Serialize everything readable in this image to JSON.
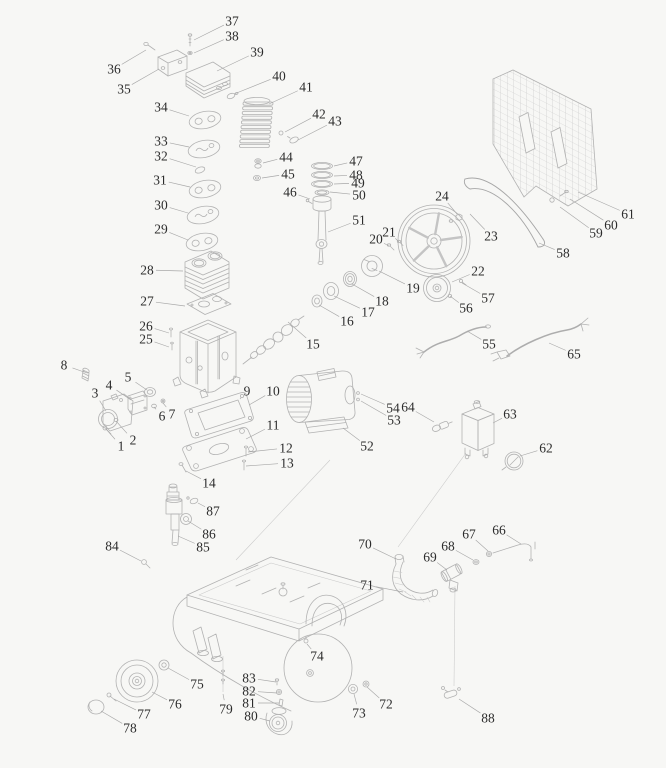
{
  "page": {
    "background_color": "#f7f7f5",
    "line_color": "#b2b2b2",
    "leader_color": "#a8a8a8",
    "label_color": "#2c2c2c"
  },
  "diagram": {
    "type": "exploded-parts-diagram",
    "subject": "belt-driven air compressor parts schematic",
    "part_count": 88,
    "callouts": [
      {
        "n": "1",
        "x": 121,
        "y": 446,
        "tx": 106,
        "ty": 429
      },
      {
        "n": "2",
        "x": 133,
        "y": 440,
        "tx": 116,
        "ty": 421
      },
      {
        "n": "3",
        "x": 95,
        "y": 393,
        "tx": 106,
        "ty": 411
      },
      {
        "n": "4",
        "x": 109,
        "y": 385,
        "tx": 131,
        "ty": 400
      },
      {
        "n": "5",
        "x": 128,
        "y": 377,
        "tx": 147,
        "ty": 390
      },
      {
        "n": "6",
        "x": 162,
        "y": 416,
        "tx": 154,
        "ty": 407
      },
      {
        "n": "7",
        "x": 172,
        "y": 414,
        "tx": 163,
        "ty": 403
      },
      {
        "n": "8",
        "x": 64,
        "y": 365,
        "tx": 84,
        "ty": 372
      },
      {
        "n": "9",
        "x": 247,
        "y": 391,
        "tx": 240,
        "ty": 399
      },
      {
        "n": "10",
        "x": 273,
        "y": 391,
        "tx": 249,
        "ty": 405
      },
      {
        "n": "11",
        "x": 273,
        "y": 425,
        "tx": 246,
        "ty": 439
      },
      {
        "n": "12",
        "x": 286,
        "y": 448,
        "tx": 248,
        "ty": 452
      },
      {
        "n": "13",
        "x": 287,
        "y": 463,
        "tx": 246,
        "ty": 466
      },
      {
        "n": "14",
        "x": 209,
        "y": 483,
        "tx": 186,
        "ty": 471
      },
      {
        "n": "15",
        "x": 313,
        "y": 344,
        "tx": 288,
        "ty": 322
      },
      {
        "n": "16",
        "x": 347,
        "y": 321,
        "tx": 319,
        "ty": 305
      },
      {
        "n": "17",
        "x": 368,
        "y": 312,
        "tx": 334,
        "ty": 296
      },
      {
        "n": "18",
        "x": 382,
        "y": 301,
        "tx": 352,
        "ty": 284
      },
      {
        "n": "19",
        "x": 413,
        "y": 288,
        "tx": 379,
        "ty": 271
      },
      {
        "n": "20",
        "x": 376,
        "y": 239,
        "tx": 389,
        "ty": 246
      },
      {
        "n": "21",
        "x": 389,
        "y": 232,
        "tx": 399,
        "ty": 242
      },
      {
        "n": "22",
        "x": 478,
        "y": 271,
        "tx": 452,
        "ty": 282
      },
      {
        "n": "23",
        "x": 491,
        "y": 236,
        "tx": 470,
        "ty": 214
      },
      {
        "n": "24",
        "x": 442,
        "y": 196,
        "tx": 457,
        "ty": 214
      },
      {
        "n": "25",
        "x": 146,
        "y": 339,
        "tx": 169,
        "ty": 347
      },
      {
        "n": "26",
        "x": 146,
        "y": 326,
        "tx": 169,
        "ty": 333
      },
      {
        "n": "27",
        "x": 147,
        "y": 301,
        "tx": 185,
        "ty": 306
      },
      {
        "n": "28",
        "x": 147,
        "y": 270,
        "tx": 183,
        "ty": 271
      },
      {
        "n": "29",
        "x": 161,
        "y": 229,
        "tx": 188,
        "ty": 240
      },
      {
        "n": "30",
        "x": 161,
        "y": 205,
        "tx": 188,
        "ty": 213
      },
      {
        "n": "31",
        "x": 160,
        "y": 180,
        "tx": 190,
        "ty": 187
      },
      {
        "n": "32",
        "x": 161,
        "y": 156,
        "tx": 196,
        "ty": 167
      },
      {
        "n": "33",
        "x": 161,
        "y": 141,
        "tx": 189,
        "ty": 147
      },
      {
        "n": "34",
        "x": 161,
        "y": 107,
        "tx": 189,
        "ty": 116
      },
      {
        "n": "35",
        "x": 124,
        "y": 89,
        "tx": 159,
        "ty": 69
      },
      {
        "n": "36",
        "x": 114,
        "y": 69,
        "tx": 146,
        "ty": 50
      },
      {
        "n": "37",
        "x": 232,
        "y": 21,
        "tx": 194,
        "ty": 40
      },
      {
        "n": "38",
        "x": 232,
        "y": 36,
        "tx": 194,
        "ty": 53
      },
      {
        "n": "39",
        "x": 257,
        "y": 52,
        "tx": 217,
        "ty": 71
      },
      {
        "n": "40",
        "x": 279,
        "y": 76,
        "tx": 234,
        "ty": 94
      },
      {
        "n": "41",
        "x": 306,
        "y": 87,
        "tx": 269,
        "ty": 104
      },
      {
        "n": "42",
        "x": 319,
        "y": 114,
        "tx": 285,
        "ty": 132
      },
      {
        "n": "43",
        "x": 335,
        "y": 121,
        "tx": 298,
        "ty": 140
      },
      {
        "n": "44",
        "x": 286,
        "y": 157,
        "tx": 263,
        "ty": 163
      },
      {
        "n": "45",
        "x": 288,
        "y": 174,
        "tx": 262,
        "ty": 178
      },
      {
        "n": "46",
        "x": 290,
        "y": 192,
        "tx": 310,
        "ty": 199
      },
      {
        "n": "47",
        "x": 356,
        "y": 161,
        "tx": 334,
        "ty": 166
      },
      {
        "n": "48",
        "x": 356,
        "y": 175,
        "tx": 334,
        "ty": 176
      },
      {
        "n": "49",
        "x": 358,
        "y": 183,
        "tx": 334,
        "ty": 184
      },
      {
        "n": "50",
        "x": 359,
        "y": 195,
        "tx": 330,
        "ty": 192
      },
      {
        "n": "51",
        "x": 359,
        "y": 220,
        "tx": 328,
        "ty": 232
      },
      {
        "n": "52",
        "x": 367,
        "y": 446,
        "tx": 343,
        "ty": 428
      },
      {
        "n": "53",
        "x": 394,
        "y": 420,
        "tx": 361,
        "ty": 401
      },
      {
        "n": "54",
        "x": 393,
        "y": 408,
        "tx": 361,
        "ty": 394
      },
      {
        "n": "55",
        "x": 489,
        "y": 344,
        "tx": 467,
        "ty": 331
      },
      {
        "n": "56",
        "x": 466,
        "y": 308,
        "tx": 450,
        "ty": 296
      },
      {
        "n": "57",
        "x": 488,
        "y": 298,
        "tx": 462,
        "ty": 283
      },
      {
        "n": "58",
        "x": 563,
        "y": 253,
        "tx": 539,
        "ty": 243
      },
      {
        "n": "59",
        "x": 596,
        "y": 233,
        "tx": 560,
        "ty": 207
      },
      {
        "n": "60",
        "x": 611,
        "y": 225,
        "tx": 570,
        "ty": 199
      },
      {
        "n": "61",
        "x": 628,
        "y": 214,
        "tx": 578,
        "ty": 192
      },
      {
        "n": "62",
        "x": 546,
        "y": 448,
        "tx": 520,
        "ty": 456
      },
      {
        "n": "63",
        "x": 510,
        "y": 414,
        "tx": 493,
        "ty": 423
      },
      {
        "n": "64",
        "x": 408,
        "y": 407,
        "tx": 434,
        "ty": 422
      },
      {
        "n": "65",
        "x": 574,
        "y": 354,
        "tx": 549,
        "ty": 343
      },
      {
        "n": "66",
        "x": 499,
        "y": 530,
        "tx": 521,
        "ty": 544
      },
      {
        "n": "67",
        "x": 469,
        "y": 534,
        "tx": 488,
        "ty": 551
      },
      {
        "n": "68",
        "x": 448,
        "y": 546,
        "tx": 473,
        "ty": 560
      },
      {
        "n": "69",
        "x": 430,
        "y": 557,
        "tx": 447,
        "ty": 570
      },
      {
        "n": "70",
        "x": 365,
        "y": 544,
        "tx": 396,
        "ty": 559
      },
      {
        "n": "71",
        "x": 367,
        "y": 585,
        "tx": 403,
        "ty": 592
      },
      {
        "n": "72",
        "x": 386,
        "y": 704,
        "tx": 367,
        "ty": 687
      },
      {
        "n": "73",
        "x": 359,
        "y": 713,
        "tx": 354,
        "ty": 694
      },
      {
        "n": "74",
        "x": 317,
        "y": 656,
        "tx": 307,
        "ty": 644
      },
      {
        "n": "75",
        "x": 197,
        "y": 684,
        "tx": 168,
        "ty": 668
      },
      {
        "n": "76",
        "x": 175,
        "y": 704,
        "tx": 152,
        "ty": 692
      },
      {
        "n": "77",
        "x": 144,
        "y": 714,
        "tx": 114,
        "ty": 699
      },
      {
        "n": "78",
        "x": 130,
        "y": 728,
        "tx": 101,
        "ty": 711
      },
      {
        "n": "79",
        "x": 226,
        "y": 709,
        "tx": 223,
        "ty": 694
      },
      {
        "n": "80",
        "x": 251,
        "y": 716,
        "tx": 270,
        "ty": 721
      },
      {
        "n": "81",
        "x": 249,
        "y": 703,
        "tx": 279,
        "ty": 703
      },
      {
        "n": "82",
        "x": 249,
        "y": 691,
        "tx": 277,
        "ty": 693
      },
      {
        "n": "83",
        "x": 249,
        "y": 678,
        "tx": 276,
        "ty": 682
      },
      {
        "n": "84",
        "x": 112,
        "y": 546,
        "tx": 141,
        "ty": 561
      },
      {
        "n": "85",
        "x": 203,
        "y": 547,
        "tx": 178,
        "ty": 536
      },
      {
        "n": "86",
        "x": 209,
        "y": 534,
        "tx": 188,
        "ty": 521
      },
      {
        "n": "87",
        "x": 213,
        "y": 511,
        "tx": 198,
        "ty": 503
      },
      {
        "n": "88",
        "x": 488,
        "y": 718,
        "tx": 459,
        "ty": 699
      }
    ]
  }
}
